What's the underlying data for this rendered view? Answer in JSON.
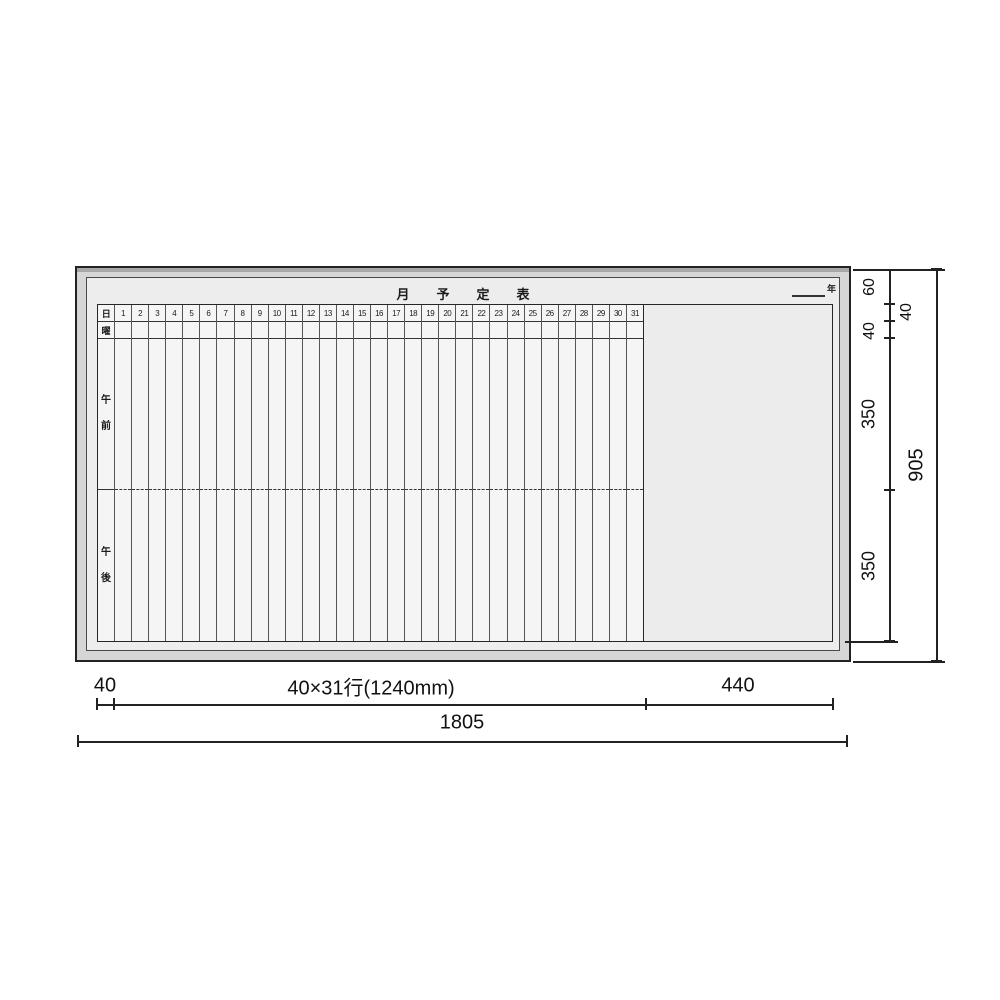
{
  "board": {
    "title": "月予定表",
    "year_suffix": "年",
    "grid": {
      "corner_header": "日",
      "weekday_label": "曜",
      "morning_chars": [
        "午",
        "前"
      ],
      "afternoon_chars": [
        "午",
        "後"
      ],
      "days": [
        "1",
        "2",
        "3",
        "4",
        "5",
        "6",
        "7",
        "8",
        "9",
        "10",
        "11",
        "12",
        "13",
        "14",
        "15",
        "16",
        "17",
        "18",
        "19",
        "20",
        "21",
        "22",
        "23",
        "24",
        "25",
        "26",
        "27",
        "28",
        "29",
        "30",
        "31"
      ]
    },
    "colors": {
      "frame_fill": "#d6d6d6",
      "interior_fill": "#ededed",
      "surface_fill": "#f5f5f5",
      "line": "#222222"
    }
  },
  "dims": {
    "right": {
      "segments": [
        "60",
        "40",
        "40",
        "350",
        "350"
      ],
      "total": "905"
    },
    "bottom": {
      "label_col": "40",
      "grid_span": "40×31行(1240mm)",
      "blank_span": "440",
      "total": "1805"
    }
  }
}
